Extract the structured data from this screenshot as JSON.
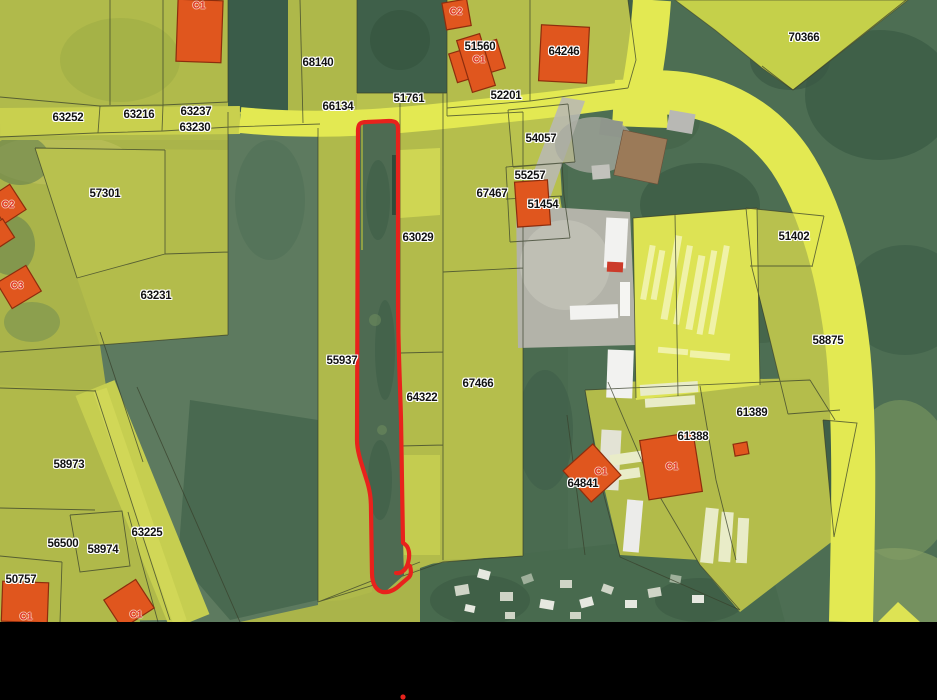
{
  "map": {
    "parcel_labels": [
      {
        "text": "63252"
      },
      {
        "text": "63216"
      },
      {
        "text": "63237"
      },
      {
        "text": "63230"
      },
      {
        "text": "68140"
      },
      {
        "text": "66134"
      },
      {
        "text": "51761"
      },
      {
        "text": "52201"
      },
      {
        "text": "51560"
      },
      {
        "text": "64246"
      },
      {
        "text": "70366"
      },
      {
        "text": "57301"
      },
      {
        "text": "54057"
      },
      {
        "text": "55257"
      },
      {
        "text": "51454"
      },
      {
        "text": "67467"
      },
      {
        "text": "63029"
      },
      {
        "text": "51402"
      },
      {
        "text": "63231"
      },
      {
        "text": "55937"
      },
      {
        "text": "64322"
      },
      {
        "text": "67466"
      },
      {
        "text": "58875"
      },
      {
        "text": "61389"
      },
      {
        "text": "61388"
      },
      {
        "text": "64841"
      },
      {
        "text": "58973"
      },
      {
        "text": "63225"
      },
      {
        "text": "56500"
      },
      {
        "text": "58974"
      },
      {
        "text": "50757"
      }
    ],
    "zone_labels": [
      {
        "text": "C1"
      },
      {
        "text": "C2"
      },
      {
        "text": "C1"
      },
      {
        "text": "C2"
      },
      {
        "text": "C3"
      },
      {
        "text": "C1"
      },
      {
        "text": "C1"
      },
      {
        "text": "C1"
      },
      {
        "text": "C1"
      }
    ],
    "palette": {
      "parcel_olive": "#b2bb4a",
      "road_yellow": "#e3e952",
      "forest_green": "#4b6c51",
      "building_orange": "#e0561e",
      "boundary_line": "#38402b",
      "label_text": "#121212",
      "label_halo": "#ffffff",
      "zone_label_red": "#e0301e",
      "highlight_red": "#e8221c",
      "footer_bar": "#000000"
    }
  }
}
